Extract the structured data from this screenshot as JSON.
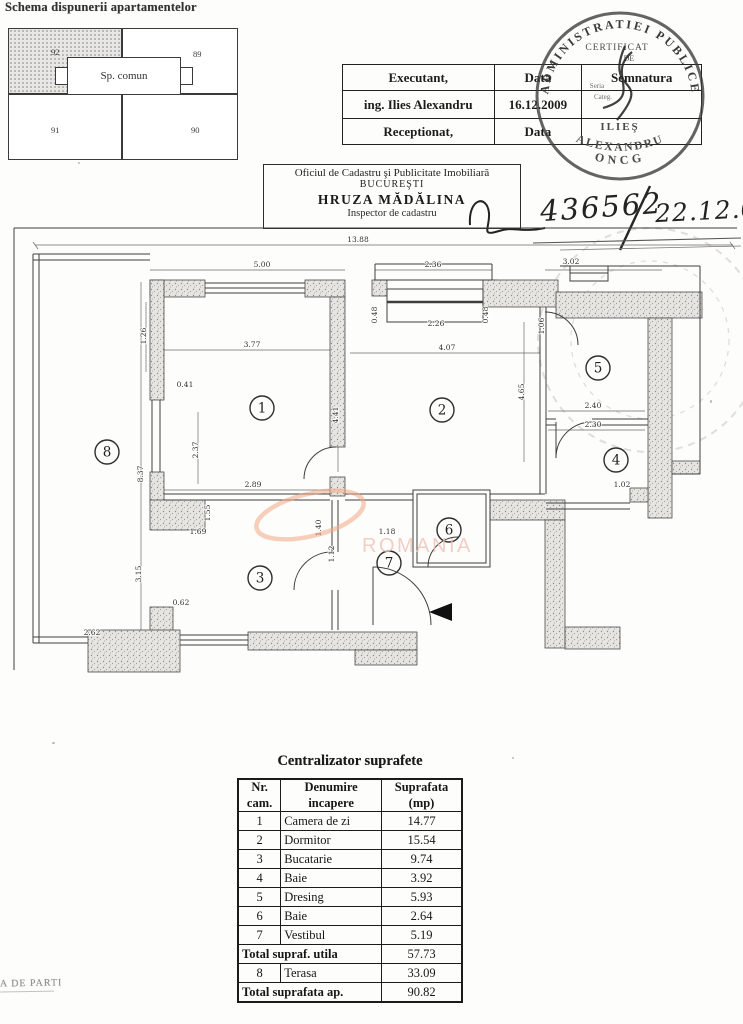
{
  "document": {
    "schema_title": "Schema dispunerii apartamentelor",
    "corner_fragment": "A DE PARTI",
    "registration_number": "436562",
    "registration_date": "22.12.09"
  },
  "apartment_schema": {
    "common_space_label": "Sp. comun",
    "units": {
      "tl": "92",
      "tr": "89",
      "bl": "91",
      "br": "90"
    }
  },
  "executant_table": {
    "rows": [
      {
        "c1": "Executant,",
        "c2": "Data",
        "c3": "Semnatura"
      },
      {
        "c1": "ing. Ilies Alexandru",
        "c2": "16.12.2009",
        "c3": ""
      },
      {
        "c1": "Receptionat,",
        "c2": "Data",
        "c3": ""
      }
    ]
  },
  "round_stamp": {
    "arc_text": "ADMINISTRATIEI PUBLICE",
    "cert_line1": "CERTIFICAT",
    "cert_line2": "DE",
    "seria_label": "Seria",
    "categ_label": "Categ.",
    "name_line": "ILIEŞ",
    "name_arc": "ALEXANDRU",
    "bottom_arc": "ONCG"
  },
  "cadastre_office": {
    "office_line1": "Oficiul de Cadastru şi Publicitate Imobiliară",
    "office_line2": "BUCUREŞTI",
    "inspector_name": "HRUZA MĂDĂLINA",
    "inspector_role": "Inspector de cadastru"
  },
  "floor_plan": {
    "watermark_text": "ROMANIA",
    "watermark_accent_color": "#f0a883",
    "watermark_text_color": "#efc3b6",
    "rooms": [
      {
        "n": "1",
        "x": 262,
        "y": 186
      },
      {
        "n": "2",
        "x": 442,
        "y": 188
      },
      {
        "n": "3",
        "x": 260,
        "y": 356
      },
      {
        "n": "4",
        "x": 616,
        "y": 238
      },
      {
        "n": "5",
        "x": 598,
        "y": 146
      },
      {
        "n": "6",
        "x": 449,
        "y": 308
      },
      {
        "n": "7",
        "x": 389,
        "y": 341
      },
      {
        "n": "8",
        "x": 107,
        "y": 230
      }
    ],
    "dimensions": [
      {
        "t": "13.88",
        "x": 358,
        "y": 20
      },
      {
        "t": "5.00",
        "x": 262,
        "y": 45
      },
      {
        "t": "2.36",
        "x": 433,
        "y": 45
      },
      {
        "t": "3.02",
        "x": 571,
        "y": 42
      },
      {
        "t": "2.26",
        "x": 436,
        "y": 104
      },
      {
        "t": "4.07",
        "x": 447,
        "y": 128
      },
      {
        "t": "3.77",
        "x": 252,
        "y": 125
      },
      {
        "t": "0.48",
        "x": 377,
        "y": 93,
        "v": 1
      },
      {
        "t": "0.48",
        "x": 488,
        "y": 93,
        "v": 1
      },
      {
        "t": "4.41",
        "x": 338,
        "y": 193,
        "v": 1
      },
      {
        "t": "4.65",
        "x": 524,
        "y": 170,
        "v": 1
      },
      {
        "t": "1.06",
        "x": 544,
        "y": 104,
        "v": 1
      },
      {
        "t": "2.40",
        "x": 593,
        "y": 186
      },
      {
        "t": "2.30",
        "x": 593,
        "y": 205
      },
      {
        "t": "1.02",
        "x": 622,
        "y": 265
      },
      {
        "t": "2.89",
        "x": 253,
        "y": 265
      },
      {
        "t": "1.69",
        "x": 198,
        "y": 312
      },
      {
        "t": "1.55",
        "x": 210,
        "y": 291,
        "v": 1
      },
      {
        "t": "1.18",
        "x": 387,
        "y": 312
      },
      {
        "t": "1.12",
        "x": 334,
        "y": 332,
        "v": 1
      },
      {
        "t": "1.40",
        "x": 321,
        "y": 306,
        "v": 1
      },
      {
        "t": "0.62",
        "x": 181,
        "y": 383
      },
      {
        "t": "2.62",
        "x": 92,
        "y": 413
      },
      {
        "t": "3.15",
        "x": 141,
        "y": 352,
        "v": 1
      },
      {
        "t": "8.37",
        "x": 143,
        "y": 252,
        "v": 1
      },
      {
        "t": "2.37",
        "x": 198,
        "y": 228,
        "v": 1
      },
      {
        "t": "1.26",
        "x": 146,
        "y": 114,
        "v": 1
      },
      {
        "t": "0.41",
        "x": 185,
        "y": 165
      }
    ]
  },
  "areas_table": {
    "title": "Centralizator suprafete",
    "headers": [
      {
        "l1": "Nr.",
        "l2": "cam."
      },
      {
        "l1": "Denumire",
        "l2": "incapere"
      },
      {
        "l1": "Suprafata",
        "l2": "(mp)"
      }
    ],
    "rows": [
      {
        "nr": "1",
        "name": "Camera de zi",
        "area": "14.77"
      },
      {
        "nr": "2",
        "name": "Dormitor",
        "area": "15.54"
      },
      {
        "nr": "3",
        "name": "Bucatarie",
        "area": "9.74"
      },
      {
        "nr": "4",
        "name": "Baie",
        "area": "3.92"
      },
      {
        "nr": "5",
        "name": "Dresing",
        "area": "5.93"
      },
      {
        "nr": "6",
        "name": "Baie",
        "area": "2.64"
      },
      {
        "nr": "7",
        "name": "Vestibul",
        "area": "5.19"
      }
    ],
    "total_useful_label": "Total supraf. utila",
    "total_useful_value": "57.73",
    "terrace_row": {
      "nr": "8",
      "name": "Terasa",
      "area": "33.09"
    },
    "total_label": "Total suprafata ap.",
    "total_value": "90.82"
  }
}
